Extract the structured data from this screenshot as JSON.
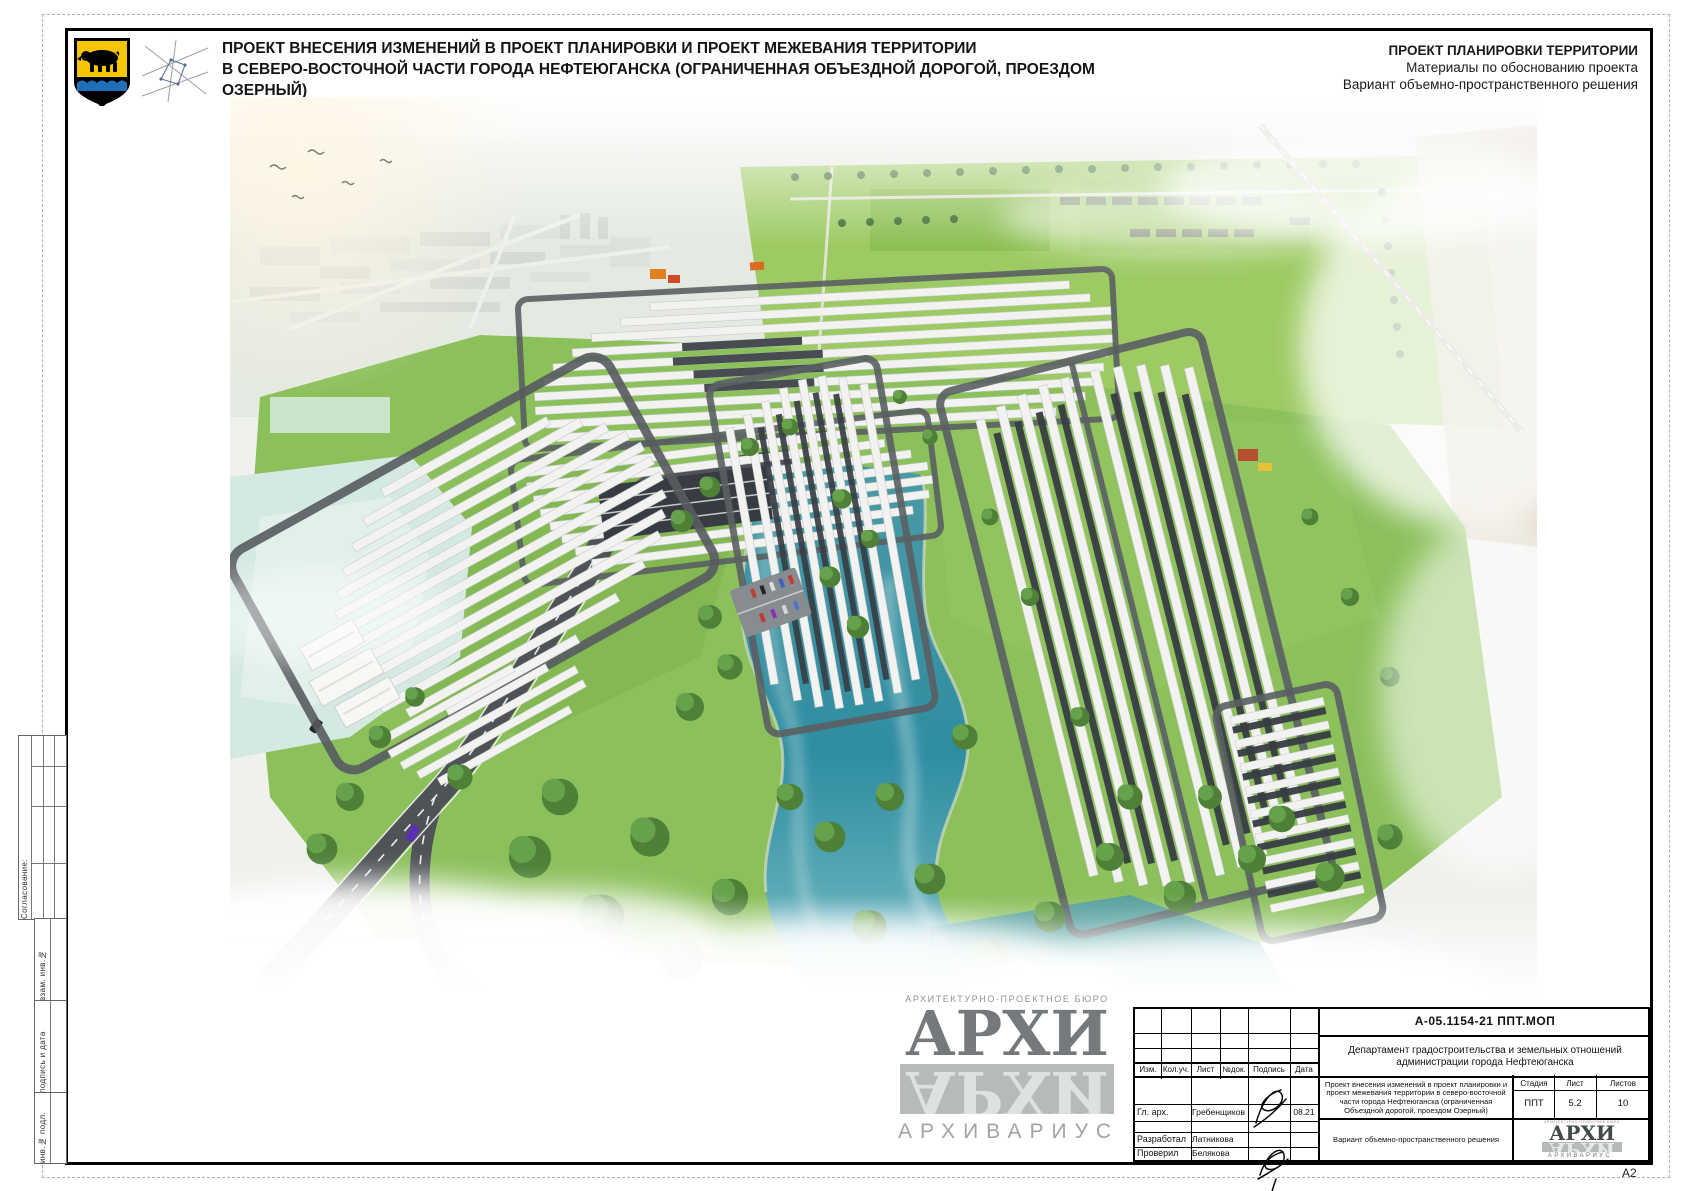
{
  "sheet": {
    "format_label": "А2"
  },
  "header": {
    "emblem_icon": "nefteyugansk-coat-of-arms",
    "logo_icon": "geometric-star-logo",
    "title_line1": "ПРОЕКТ ВНЕСЕНИЯ ИЗМЕНЕНИЙ В ПРОЕКТ ПЛАНИРОВКИ И ПРОЕКТ МЕЖЕВАНИЯ ТЕРРИТОРИИ",
    "title_line2": "В СЕВЕРО-ВОСТОЧНОЙ ЧАСТИ ГОРОДА НЕФТЕЮГАНСКА (ОГРАНИЧЕННАЯ ОБЪЕЗДНОЙ ДОРОГОЙ, ПРОЕЗДОМ ОЗЕРНЫЙ)",
    "right_line1": "ПРОЕКТ ПЛАНИРОВКИ ТЕРРИТОРИИ",
    "right_line2": "Материалы по обоснованию проекта",
    "right_line3": "Вариант объемно-пространственного решения"
  },
  "side_labels": {
    "soglasovanie": "Согласование:",
    "vzam": "взам. инв.№",
    "podpis": "подпись и дата",
    "inv": "инв.№ подл."
  },
  "watermark": {
    "bureau": "АРХИТЕКТУРНО-ПРОЕКТНОЕ БЮРО",
    "name": "АРХИ",
    "reflection": "АРХИ",
    "subtitle": "АРХИВАРИУС"
  },
  "title_block": {
    "doc_number": "А-05.1154-21 ППТ.МОП",
    "organization": "Департамент градостроительства и земельных отношений администрации города Нефтеюганска",
    "columns": [
      "Изм.",
      "Кол.уч.",
      "Лист",
      "№док.",
      "Подпись",
      "Дата"
    ],
    "rows": [
      {
        "role": "Гл. арх.",
        "name": "Гребенщиков",
        "date": "08.21"
      },
      {
        "role": "Разработал",
        "name": "Латникова",
        "date": ""
      },
      {
        "role": "Проверил",
        "name": "Белякова",
        "date": ""
      }
    ],
    "project_description": "Проект внесения изменений в проект планировки и проект межевания территории в северо-восточной части города Нефтеюганска (ограниченная Объездной дорогой, проездом Озерный)",
    "sheet_title": "Вариант объемно-пространственного решения",
    "stage_label": "Стадия",
    "stage_value": "ППТ",
    "sheet_label": "Лист",
    "sheet_value": "5.2",
    "sheets_label": "Листов",
    "sheets_value": "10",
    "logo_top": "АРХИТЕКТУРНО-ПРОЕКТНОЕ БЮРО",
    "logo_main": "АРХИ",
    "logo_reflection": "АРХИ",
    "logo_sub": "АРХИВАРИУС."
  },
  "render_palette": {
    "grass": "#8CC05B",
    "field": "#9DCA62",
    "trees": "#4E8038",
    "water": "#3E97A8",
    "road": "#4F5357",
    "building_roof": "#F2F3F0",
    "dark_rows": "#3A4046",
    "sand": "#D8CDB6",
    "haze": "#FFFFFF",
    "emblem_gold": "#F5C500",
    "emblem_blue": "#1E6FB8"
  }
}
